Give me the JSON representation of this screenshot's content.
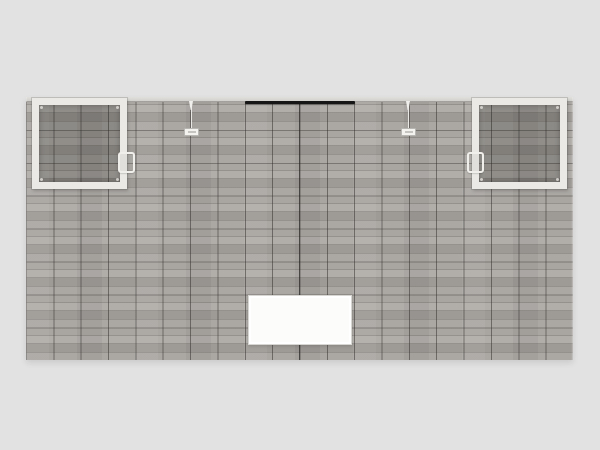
{
  "scene": {
    "description": "3D product render of a straight modular trade-show exhibit back wall clad in gray wood-plank laminate panels, with two white-framed tinted display cases with pull handles, a black hanging light bar at top center, two hanging clips with small white tags, and a white rectangular insert panel at bottom center on a plain light-gray background",
    "background_color": "#e2e2e2"
  },
  "colors": {
    "background": "#e2e2e2",
    "wood_base": "#a6a29e",
    "seam_v": "rgba(45,42,39,0.5)",
    "seam_h": "rgba(45,42,39,0.38)",
    "center_seam": "rgba(30,28,26,0.6)",
    "top_cap": "#e0dfdb",
    "frame": "#eae9e6",
    "glass_tint": "rgba(32,30,28,0.22)",
    "light_bar": "#161616",
    "hardware": "#f1efec",
    "tag_face": "#f4f3f0",
    "tag_border": "#b8b6b2",
    "insert_face": "#fcfcfb",
    "insert_border": "#d8d6d3"
  }
}
